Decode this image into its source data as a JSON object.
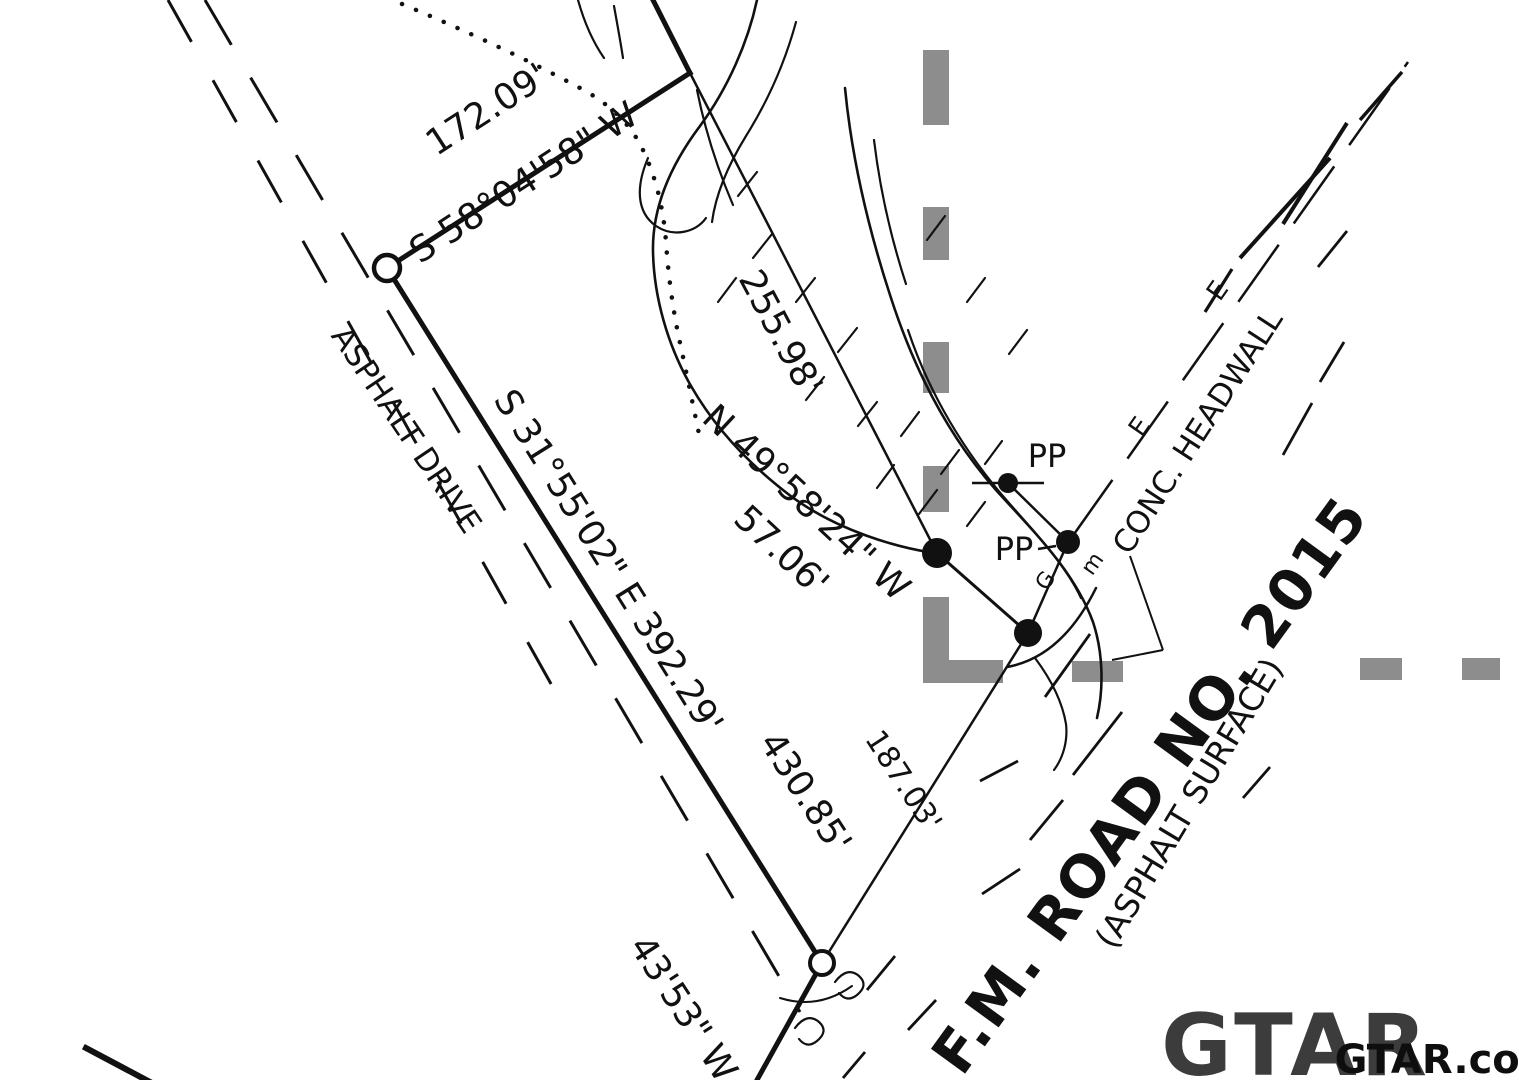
{
  "meta": {
    "type": "land-survey-plat",
    "background": "#ffffff",
    "ink": "#111111",
    "gray_overlay": "#8d8d8d",
    "logo_color": "#3c3c3c",
    "watermark_color": "#0e0e0e"
  },
  "labels": [
    {
      "name": "distance-172-09",
      "text": "172.09'",
      "x": 487,
      "y": 110,
      "rot": -33,
      "size": 36,
      "weight": 400
    },
    {
      "name": "bearing-s58-04-58-w",
      "text": "S 58°04'58\" W",
      "x": 524,
      "y": 183,
      "rot": -33,
      "size": 36,
      "weight": 400
    },
    {
      "name": "road-label-asphalt-drive",
      "text": "ASPHALT DRIVE",
      "x": 406,
      "y": 430,
      "rot": 56,
      "size": 31,
      "weight": 400
    },
    {
      "name": "bearing-s31-55-02-e-392-29",
      "text": "S 31°55'02\" E 392.29'",
      "x": 608,
      "y": 562,
      "rot": 58,
      "size": 36,
      "weight": 400
    },
    {
      "name": "distance-255-98",
      "text": "255.98'",
      "x": 780,
      "y": 333,
      "rot": 62,
      "size": 36,
      "weight": 400
    },
    {
      "name": "bearing-n49-58-24-w",
      "text": "N 49°58'24\" W",
      "x": 806,
      "y": 503,
      "rot": 43,
      "size": 36,
      "weight": 400
    },
    {
      "name": "distance-57-06",
      "text": "57.06'",
      "x": 781,
      "y": 551,
      "rot": 43,
      "size": 36,
      "weight": 400
    },
    {
      "name": "power-pole-label-1",
      "text": "PP",
      "x": 1047,
      "y": 456,
      "rot": 0,
      "size": 32,
      "weight": 400
    },
    {
      "name": "power-pole-label-2",
      "text": "PP",
      "x": 1014,
      "y": 549,
      "rot": 0,
      "size": 32,
      "weight": 400
    },
    {
      "name": "conc-headwall-label",
      "text": "CONC. HEADWALL",
      "x": 1198,
      "y": 432,
      "rot": -57,
      "size": 31,
      "weight": 400
    },
    {
      "name": "electric-line-mark-1",
      "text": "E",
      "x": 1218,
      "y": 291,
      "rot": -55,
      "size": 26,
      "weight": 400
    },
    {
      "name": "electric-line-mark-2",
      "text": "E",
      "x": 1140,
      "y": 427,
      "rot": -55,
      "size": 26,
      "weight": 400
    },
    {
      "name": "utility-mark-g",
      "text": "G",
      "x": 1046,
      "y": 581,
      "rot": -55,
      "size": 22,
      "weight": 400
    },
    {
      "name": "utility-mark-m",
      "text": "m",
      "x": 1093,
      "y": 564,
      "rot": -55,
      "size": 22,
      "weight": 400
    },
    {
      "name": "road-label-fm-road-2015",
      "text": "F.M. ROAD NO. 2015",
      "x": 1150,
      "y": 785,
      "rot": -54,
      "size": 58,
      "weight": 700,
      "ls": 2
    },
    {
      "name": "road-label-asphalt-surface",
      "text": "(ASPHALT SURFACE)",
      "x": 1189,
      "y": 803,
      "rot": -59,
      "size": 33,
      "weight": 400
    },
    {
      "name": "distance-430-85",
      "text": "430.85'",
      "x": 805,
      "y": 793,
      "rot": 57,
      "size": 36,
      "weight": 400
    },
    {
      "name": "distance-187-03",
      "text": "187.03'",
      "x": 903,
      "y": 781,
      "rot": 57,
      "size": 30,
      "weight": 400
    },
    {
      "name": "bearing-partial-43-53-w",
      "text": "43'53\" W",
      "x": 683,
      "y": 1009,
      "rot": 57,
      "size": 36,
      "weight": 400
    },
    {
      "name": "gtar-logo",
      "text": "GTAR",
      "x": 1296,
      "y": 1046,
      "rot": 0,
      "size": 86,
      "weight": 700,
      "color": "#3c3c3c",
      "ls": 4
    },
    {
      "name": "gtar-watermark",
      "text": "GTAR.com",
      "x": 1448,
      "y": 1060,
      "rot": 0,
      "size": 40,
      "weight": 700,
      "color": "#0e0e0e"
    }
  ],
  "boundary_lines": [
    {
      "name": "boundary-north-segment",
      "x1": 653,
      "y1": 0,
      "x2": 690,
      "y2": 73,
      "w": 5
    },
    {
      "name": "boundary-s58-line",
      "x1": 690,
      "y1": 73,
      "x2": 387,
      "y2": 268,
      "w": 5
    },
    {
      "name": "boundary-s31-line",
      "x1": 387,
      "y1": 268,
      "x2": 822,
      "y2": 963,
      "w": 5
    },
    {
      "name": "boundary-s43-line",
      "x1": 822,
      "y1": 963,
      "x2": 757,
      "y2": 1080,
      "w": 5
    },
    {
      "name": "southwest-corner-line",
      "x1": 86,
      "y1": 1048,
      "x2": 150,
      "y2": 1082,
      "w": 6
    }
  ],
  "survey_lines": [
    {
      "name": "creek-tie-line-255",
      "x1": 690,
      "y1": 73,
      "x2": 937,
      "y2": 553,
      "w": 2.5
    },
    {
      "name": "creek-tie-line-57",
      "x1": 937,
      "y1": 553,
      "x2": 1028,
      "y2": 633,
      "w": 3
    },
    {
      "name": "road-tie-line-187",
      "x1": 1028,
      "y1": 633,
      "x2": 822,
      "y2": 963,
      "w": 2.5
    }
  ],
  "leader_lines": [
    {
      "name": "pp1-crossbar",
      "x1": 972,
      "y1": 483,
      "x2": 1044,
      "y2": 483,
      "w": 2.5
    },
    {
      "name": "pp1-pp2-link",
      "x1": 1008,
      "y1": 483,
      "x2": 1068,
      "y2": 542,
      "w": 2.5
    },
    {
      "name": "pp2-road-drop",
      "x1": 1068,
      "y1": 542,
      "x2": 1028,
      "y2": 633,
      "w": 2.5
    },
    {
      "name": "pp2-label-tie",
      "x1": 1038,
      "y1": 549,
      "x2": 1056,
      "y2": 546,
      "w": 2.5
    },
    {
      "name": "headwall-leader-stem",
      "x1": 1130,
      "y1": 556,
      "x2": 1163,
      "y2": 650,
      "w": 2
    },
    {
      "name": "headwall-leader-foot",
      "x1": 1163,
      "y1": 650,
      "x2": 1112,
      "y2": 660,
      "w": 2
    }
  ],
  "dashed_lines": [
    {
      "name": "asphalt-drive-edge-inner",
      "x1": 205,
      "y1": 0,
      "x2": 800,
      "y2": 1012,
      "w": 3,
      "dash": "52 38"
    },
    {
      "name": "asphalt-drive-edge-outer",
      "x1": 168,
      "y1": 0,
      "x2": 560,
      "y2": 700,
      "w": 3,
      "dash": "48 44"
    },
    {
      "name": "overhead-electric-line",
      "x1": 1072,
      "y1": 537,
      "x2": 1408,
      "y2": 62,
      "w": 2.5,
      "dash": "70 26"
    }
  ],
  "road_dashes": [
    [
      867,
      990,
      895,
      956,
      2.8
    ],
    [
      908,
      1030,
      936,
      1000,
      2.8
    ],
    [
      843,
      1078,
      865,
      1052,
      2.8
    ],
    [
      980,
      781,
      1018,
      761,
      2.8
    ],
    [
      982,
      894,
      1020,
      869,
      2.8
    ],
    [
      1030,
      840,
      1063,
      800,
      2.8
    ],
    [
      1045,
      697,
      1090,
      634,
      2.8
    ],
    [
      1073,
      775,
      1122,
      712,
      2.8
    ],
    [
      1243,
      798,
      1270,
      767,
      2.8
    ],
    [
      1205,
      312,
      1232,
      269,
      3.2
    ],
    [
      1240,
      258,
      1330,
      158,
      4
    ],
    [
      1283,
      224,
      1347,
      123,
      4
    ],
    [
      1360,
      120,
      1402,
      72,
      3.5
    ],
    [
      1318,
      267,
      1347,
      231,
      2.8
    ],
    [
      1320,
      382,
      1344,
      342,
      2.8
    ],
    [
      1283,
      455,
      1312,
      403,
      2.8
    ]
  ],
  "creek_paths": [
    {
      "name": "creek-bank-west",
      "d": "M757,0 C748,42 728,88 700,126 C670,166 652,208 653,252 C654,298 668,346 691,386 C714,426 748,464 792,497 C840,532 898,547 928,552",
      "w": 2.6
    },
    {
      "name": "creek-bank-west-inner",
      "d": "M796,22 C784,66 766,104 746,136 C730,162 716,192 712,222",
      "w": 2.2
    },
    {
      "name": "creek-hook",
      "d": "M648,158 C636,186 636,212 656,226 C674,238 696,232 706,218",
      "w": 2.2
    },
    {
      "name": "creek-bank-east",
      "d": "M845,88 C851,150 866,222 891,298 C915,372 950,438 996,490 C1032,530 1074,570 1093,622 C1103,652 1104,688 1097,718",
      "w": 2.6
    },
    {
      "name": "creek-bank-east-inner-1",
      "d": "M874,140 C880,190 891,238 906,284",
      "w": 2.2
    },
    {
      "name": "creek-bank-east-inner-2",
      "d": "M908,330 C929,393 964,452 1009,503 C1038,536 1066,566 1081,598",
      "w": 2.2
    },
    {
      "name": "creek-below-road",
      "d": "M1035,658 C1050,678 1062,700 1066,724 C1068,741 1063,758 1054,770",
      "w": 2.2
    },
    {
      "name": "creek-top-strand-1",
      "d": "M578,0 C585,25 595,45 604,58",
      "w": 2.2
    },
    {
      "name": "creek-top-strand-2",
      "d": "M614,6 C618,28 621,45 623,58",
      "w": 2.2
    },
    {
      "name": "creek-vertex-strand",
      "d": "M697,90 C705,130 718,170 733,205",
      "w": 2.2
    },
    {
      "name": "headwall-arc",
      "d": "M1007,667 Q1062,657 1096,588",
      "w": 2.5
    },
    {
      "name": "culvert-squiggle-1",
      "d": "M835,982 q12,-16 24,-6 q10,9 -2,19 q-10,8 -18,-2",
      "w": 2.2
    },
    {
      "name": "culvert-squiggle-2",
      "d": "M795,1028 q12,-16 24,-6 q10,9 -2,19 q-10,8 -18,-2",
      "w": 2.2
    },
    {
      "name": "culvert-arc-below-circle",
      "d": "M780,998 Q818,1010 852,986",
      "w": 2
    }
  ],
  "contour_ticks": [
    [
      738,
      196,
      757,
      172
    ],
    [
      753,
      258,
      772,
      234
    ],
    [
      718,
      302,
      736,
      278
    ],
    [
      796,
      302,
      815,
      278
    ],
    [
      838,
      352,
      857,
      328
    ],
    [
      806,
      400,
      824,
      377
    ],
    [
      858,
      426,
      877,
      402
    ],
    [
      901,
      436,
      919,
      412
    ],
    [
      941,
      474,
      959,
      450
    ],
    [
      985,
      464,
      1002,
      441
    ],
    [
      919,
      514,
      937,
      490
    ],
    [
      967,
      526,
      985,
      502
    ],
    [
      877,
      488,
      894,
      465
    ],
    [
      927,
      240,
      945,
      216
    ],
    [
      967,
      302,
      985,
      278
    ],
    [
      1009,
      354,
      1027,
      330
    ]
  ],
  "dotted_paths": [
    {
      "name": "dotted-survey-trace",
      "d": "M402,4 Q500,45 580,88 Q625,112 643,150 Q662,190 666,242 Q670,300 682,352 Q692,400 699,434",
      "w": 4.5,
      "dash": "0.1 15"
    }
  ],
  "open_circles": [
    {
      "name": "corner-monument-open-1",
      "cx": 387,
      "cy": 268,
      "r": 13,
      "sw": 4.5
    },
    {
      "name": "corner-monument-open-2",
      "cx": 822,
      "cy": 963,
      "r": 12,
      "sw": 4
    }
  ],
  "filled_dots": [
    {
      "name": "creek-corner-point",
      "cx": 937,
      "cy": 553,
      "r": 15
    },
    {
      "name": "road-corner-point",
      "cx": 1028,
      "cy": 633,
      "r": 14
    },
    {
      "name": "power-pole-point-1",
      "cx": 1008,
      "cy": 483,
      "r": 10
    },
    {
      "name": "power-pole-point-2",
      "cx": 1068,
      "cy": 542,
      "r": 12
    }
  ],
  "gray_overlay_rects": [
    {
      "name": "highlight-dash-v1",
      "x": 923,
      "y": 50,
      "w": 26,
      "h": 75
    },
    {
      "name": "highlight-dash-v2",
      "x": 923,
      "y": 207,
      "w": 26,
      "h": 53
    },
    {
      "name": "highlight-dash-v3",
      "x": 923,
      "y": 342,
      "w": 26,
      "h": 51
    },
    {
      "name": "highlight-dash-v4",
      "x": 923,
      "y": 466,
      "w": 26,
      "h": 46
    },
    {
      "name": "highlight-corner-vertical",
      "x": 923,
      "y": 597,
      "w": 26,
      "h": 86
    },
    {
      "name": "highlight-corner-foot",
      "x": 923,
      "y": 660,
      "w": 80,
      "h": 23
    },
    {
      "name": "highlight-dash-h1",
      "x": 1072,
      "y": 661,
      "w": 51,
      "h": 21
    },
    {
      "name": "highlight-dash-h2",
      "x": 1360,
      "y": 658,
      "w": 42,
      "h": 22
    },
    {
      "name": "highlight-dash-h3",
      "x": 1462,
      "y": 658,
      "w": 38,
      "h": 22
    }
  ]
}
